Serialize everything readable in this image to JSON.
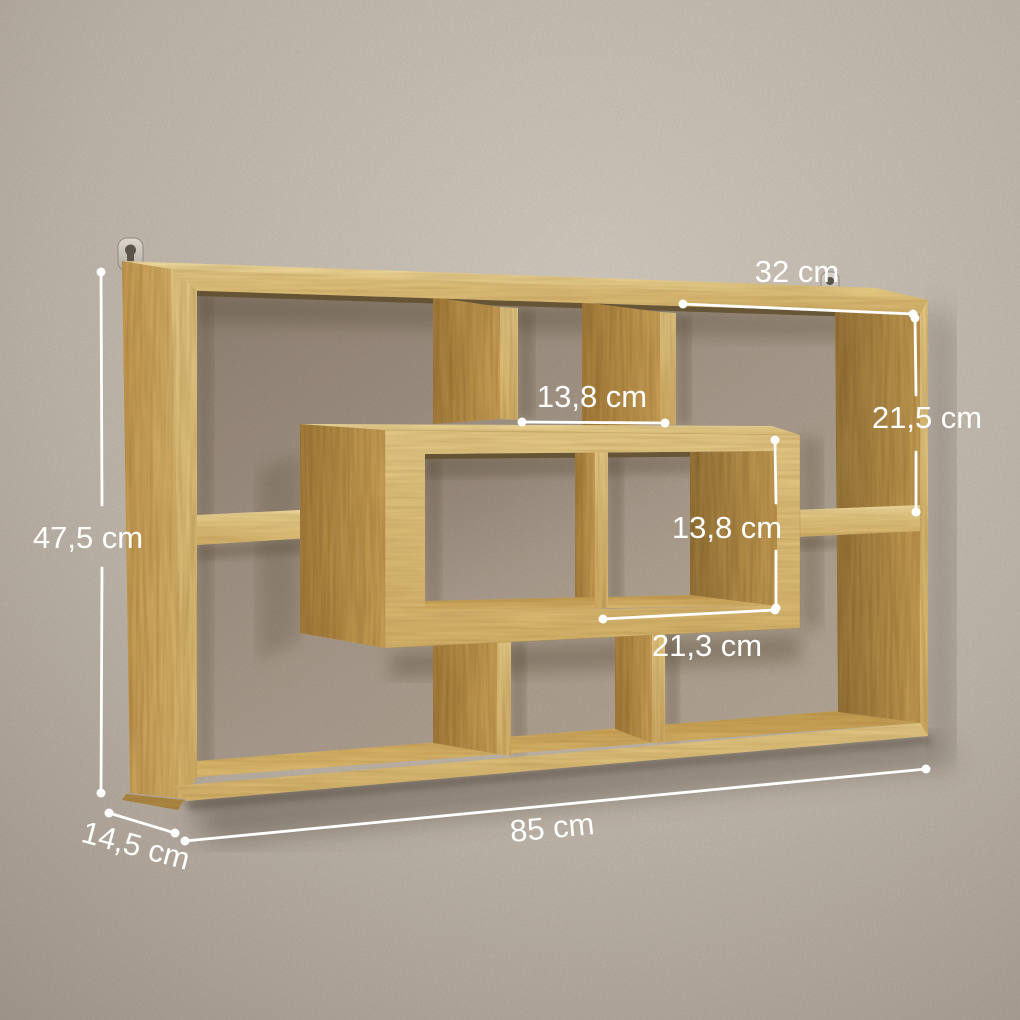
{
  "scene": {
    "subject": "wall-mounted wooden cube storage shelf with eight compartments",
    "style": "product render with dimension annotations on plaster wall"
  },
  "annotations": {
    "overall_height": "47,5 cm",
    "overall_width": "85 cm",
    "depth": "14,5 cm",
    "top_compartment_width": "32 cm",
    "right_compartment_height": "21,5 cm",
    "middle_compartment_width": "13,8 cm",
    "center_box_height": "13,8 cm",
    "center_box_width": "21,3 cm"
  },
  "colors": {
    "dimension_text": "#ffffff",
    "dimension_line": "#ffffff",
    "wood_front": "#e2c47f",
    "wood_top": "#eed896",
    "wood_side": "#bb9148",
    "wall": "#bdb4a9",
    "wall_recess": "#a4968a",
    "hanger_metal": "#cfcac1"
  }
}
